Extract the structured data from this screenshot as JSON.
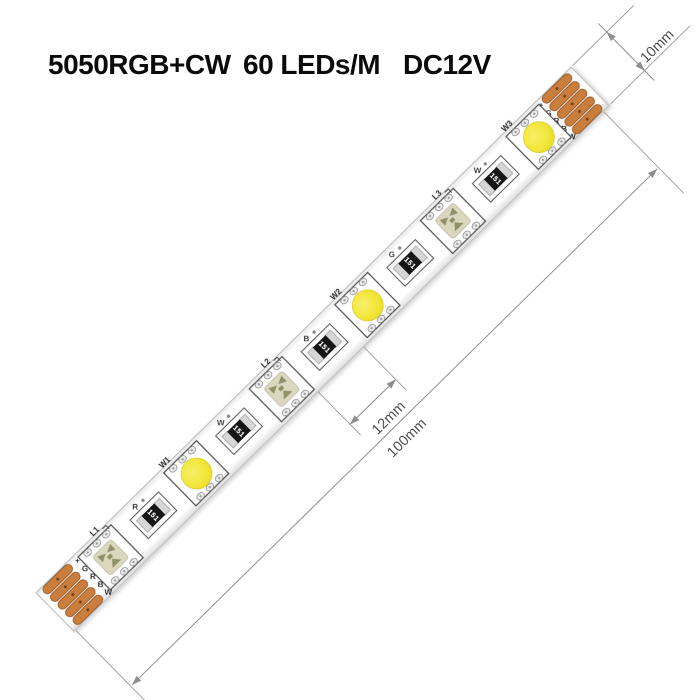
{
  "title": {
    "chip_spec": "5050RGB+CW",
    "density": "60 LEDs/M",
    "voltage": "DC12V"
  },
  "dimensions": {
    "strip_width": "10mm",
    "led_gap": "12mm",
    "section_length": "100mm"
  },
  "strip": {
    "pad_labels": [
      "+",
      "G",
      "R",
      "B",
      "W"
    ],
    "leds": [
      {
        "type": "rgb",
        "label": "L1"
      },
      {
        "type": "white",
        "label": "W1"
      },
      {
        "type": "rgb",
        "label": "L2"
      },
      {
        "type": "white",
        "label": "W2"
      },
      {
        "type": "rgb",
        "label": "L3"
      },
      {
        "type": "white",
        "label": "W3"
      }
    ],
    "resistors": [
      {
        "letter": "R",
        "code": "151"
      },
      {
        "letter": "W",
        "code": "151"
      },
      {
        "letter": "B",
        "code": "151"
      },
      {
        "letter": "G",
        "code": "151"
      },
      {
        "letter": "W",
        "code": "151"
      }
    ]
  },
  "colors": {
    "copper_pad": "#C97E3E",
    "copper_pad_border": "#9C5B24",
    "led_yellow": "#F2E73A",
    "rgb_cup_beige": "#DBD7BF",
    "rgb_chip_olive": "#8F9268",
    "resistor_body": "#161616",
    "dimension_gray": "#8f8f8f",
    "strip_white": "#ffffff"
  }
}
